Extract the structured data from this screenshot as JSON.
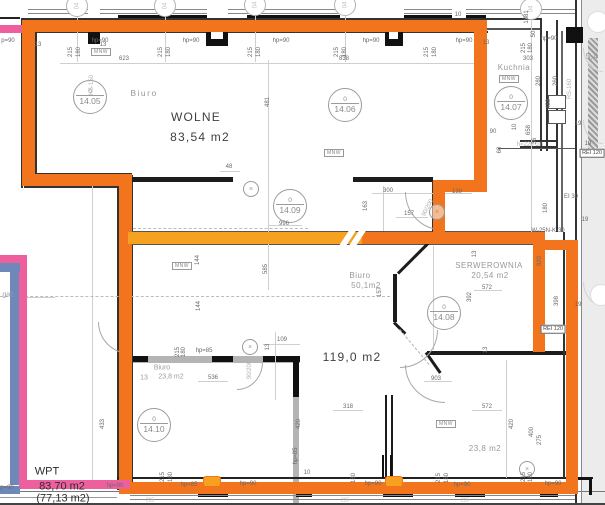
{
  "meta": {
    "kind": "architectural-floor-plan",
    "units_label": "m2"
  },
  "colors": {
    "highlight_orange": "#f2741c",
    "highlight_orange_light": "#f6a11f",
    "highlight_pink": "#ee5f9e",
    "highlight_blue": "#6e88b9",
    "wall_dark": "#1c1c1c",
    "wall_gray": "#b4b4b4",
    "zone_gray": "#ececec"
  },
  "rooms": [
    {
      "name": "wolne",
      "label": "WOLNE",
      "area": "83,54 m2"
    },
    {
      "name": "biuro-4-05",
      "label": "Biuro"
    },
    {
      "name": "biuro-50",
      "label": "Biuro",
      "area": "50,1m2"
    },
    {
      "name": "serwerownia",
      "label": "SERWEROWNIA",
      "area": "20,54 m2"
    },
    {
      "name": "kuchnia",
      "label": "Kuchnia"
    },
    {
      "name": "strefa-119",
      "area": "119,0 m2"
    },
    {
      "name": "biuro-dol",
      "label": "Biuro",
      "area": "23,8 m2",
      "width_note": "13"
    },
    {
      "name": "biuro-praw",
      "area": "23,8 m2"
    },
    {
      "name": "wpt",
      "label": "WPT",
      "area": "83,70 m2",
      "area2": "(77,13 m2)"
    },
    {
      "name": "gaz",
      "label": "gaz."
    }
  ],
  "room_tags": [
    {
      "floor": "0",
      "num": "14.05",
      "x": 90,
      "y": 97
    },
    {
      "floor": "0",
      "num": "14.06",
      "x": 345,
      "y": 105
    },
    {
      "floor": "0",
      "num": "14.07",
      "x": 511,
      "y": 103
    },
    {
      "floor": "0",
      "num": "14.08",
      "x": 444,
      "y": 313
    },
    {
      "floor": "0",
      "num": "14.09",
      "x": 290,
      "y": 206
    },
    {
      "floor": "0",
      "num": "14.10",
      "x": 154,
      "y": 425
    }
  ],
  "grid_bubbles": [
    {
      "label": "04",
      "x": 77,
      "y": 6
    },
    {
      "label": "04",
      "x": 165,
      "y": 6
    },
    {
      "label": "04",
      "x": 255,
      "y": 5
    },
    {
      "label": "04",
      "x": 345,
      "y": 5
    },
    {
      "label": "04",
      "x": 531,
      "y": 9
    },
    {
      "label": "",
      "x": 598,
      "y": 22,
      "faint": true
    },
    {
      "label": "",
      "x": 601,
      "y": 295,
      "faint": true
    }
  ],
  "mnw_label": "MNW",
  "mnw_boxes": [
    {
      "x": 101,
      "y": 52
    },
    {
      "x": 334,
      "y": 153
    },
    {
      "x": 182,
      "y": 266
    },
    {
      "x": 509,
      "y": 79
    },
    {
      "x": 446,
      "y": 424
    }
  ],
  "fire_ratings": [
    {
      "t": "REI 120",
      "x": 592,
      "y": 153
    },
    {
      "t": "REI 120",
      "x": 553,
      "y": 329
    }
  ],
  "labels": [
    {
      "t": "Biuro",
      "x": 144,
      "y": 93,
      "r": 0,
      "c": "gray-lg"
    },
    {
      "t": "WOLNE",
      "x": 196,
      "y": 117,
      "r": 0,
      "c": "big"
    },
    {
      "t": "83,54 m2",
      "x": 200,
      "y": 137,
      "r": 0,
      "c": "big"
    },
    {
      "t": "Biuro",
      "x": 360,
      "y": 276,
      "r": 0,
      "c": "gray-md"
    },
    {
      "t": "50,1m2",
      "x": 366,
      "y": 286,
      "r": 0,
      "c": "gray-md"
    },
    {
      "t": "SERWEROWNIA",
      "x": 489,
      "y": 266,
      "r": 0,
      "c": "gray-md"
    },
    {
      "t": "20,54 m2",
      "x": 490,
      "y": 276,
      "r": 0,
      "c": "gray-md"
    },
    {
      "t": "Kuchnia",
      "x": 514,
      "y": 68,
      "r": 0,
      "c": "gray-md"
    },
    {
      "t": "119,0 m2",
      "x": 352,
      "y": 357,
      "r": 0,
      "c": "big"
    },
    {
      "t": "Biuro",
      "x": 162,
      "y": 368,
      "r": 0,
      "c": "gray-sm"
    },
    {
      "t": "13",
      "x": 144,
      "y": 378,
      "r": 0,
      "c": "gray-sm"
    },
    {
      "t": "23,8 m2",
      "x": 171,
      "y": 377,
      "r": 0,
      "c": "gray-sm"
    },
    {
      "t": "23,8 m2",
      "x": 485,
      "y": 449,
      "r": 0,
      "c": "gray-md"
    },
    {
      "t": "WPT",
      "x": 47,
      "y": 472,
      "r": 0,
      "c": "wpt"
    },
    {
      "t": "83,70 m2",
      "x": 62,
      "y": 487,
      "r": 0,
      "c": "wpt"
    },
    {
      "t": "(77,13 m2)",
      "x": 63,
      "y": 499,
      "r": 0,
      "c": "wpt"
    },
    {
      "t": "gaz.",
      "x": 9,
      "y": 295,
      "r": 0,
      "c": "gray-sm"
    },
    {
      "t": "p=90",
      "x": 8,
      "y": 41,
      "r": 0,
      "c": "dim"
    },
    {
      "t": "13",
      "x": 38,
      "y": 45,
      "r": 0,
      "c": "dim"
    },
    {
      "t": "13",
      "x": 103,
      "y": 45,
      "r": 0,
      "c": "dim"
    },
    {
      "t": "215",
      "x": 71,
      "y": 52,
      "r": -90,
      "c": "dim"
    },
    {
      "t": "180",
      "x": 79,
      "y": 52,
      "r": -90,
      "c": "dim"
    },
    {
      "t": "hp=90",
      "x": 100,
      "y": 41,
      "r": 0,
      "c": "dim"
    },
    {
      "t": "623",
      "x": 124,
      "y": 59,
      "r": 0,
      "c": "dim"
    },
    {
      "t": "215",
      "x": 161,
      "y": 52,
      "r": -90,
      "c": "dim"
    },
    {
      "t": "180",
      "x": 169,
      "y": 52,
      "r": -90,
      "c": "dim"
    },
    {
      "t": "hp=90",
      "x": 191,
      "y": 41,
      "r": 0,
      "c": "dim"
    },
    {
      "t": "215",
      "x": 251,
      "y": 52,
      "r": -90,
      "c": "dim"
    },
    {
      "t": "180",
      "x": 259,
      "y": 52,
      "r": -90,
      "c": "dim"
    },
    {
      "t": "hp=90",
      "x": 281,
      "y": 41,
      "r": 0,
      "c": "dim"
    },
    {
      "t": "215",
      "x": 337,
      "y": 52,
      "r": -90,
      "c": "dim"
    },
    {
      "t": "180",
      "x": 345,
      "y": 52,
      "r": -90,
      "c": "dim"
    },
    {
      "t": "hp=90",
      "x": 371,
      "y": 41,
      "r": 0,
      "c": "dim"
    },
    {
      "t": "838",
      "x": 344,
      "y": 59,
      "r": 0,
      "c": "dim"
    },
    {
      "t": "215",
      "x": 427,
      "y": 52,
      "r": -90,
      "c": "dim"
    },
    {
      "t": "180",
      "x": 435,
      "y": 52,
      "r": -90,
      "c": "dim"
    },
    {
      "t": "hp=90",
      "x": 464,
      "y": 41,
      "r": 0,
      "c": "dim"
    },
    {
      "t": "10",
      "x": 458,
      "y": 15,
      "r": 0,
      "c": "dim"
    },
    {
      "t": "13",
      "x": 486,
      "y": 43,
      "r": 0,
      "c": "dim"
    },
    {
      "t": "1581",
      "x": 527,
      "y": 17,
      "r": -90,
      "c": "dim"
    },
    {
      "t": "50",
      "x": 534,
      "y": 34,
      "r": -90,
      "c": "dim"
    },
    {
      "t": "215",
      "x": 524,
      "y": 48,
      "r": -90,
      "c": "dim"
    },
    {
      "t": "180",
      "x": 531,
      "y": 48,
      "r": -90,
      "c": "dim"
    },
    {
      "t": "hp=90",
      "x": 549,
      "y": 39,
      "r": 0,
      "c": "dim"
    },
    {
      "t": "303",
      "x": 528,
      "y": 59,
      "r": 0,
      "c": "dim"
    },
    {
      "t": "280",
      "x": 539,
      "y": 81,
      "r": -90,
      "c": "dim"
    },
    {
      "t": "260",
      "x": 556,
      "y": 81,
      "r": -90,
      "c": "dim"
    },
    {
      "t": "488",
      "x": 549,
      "y": 104,
      "r": -90,
      "c": "dim"
    },
    {
      "t": "RS-160",
      "x": 570,
      "y": 89,
      "r": -90,
      "c": "dim faint"
    },
    {
      "t": "5,4",
      "x": 592,
      "y": 57,
      "r": 0,
      "c": "gray-md"
    },
    {
      "t": "KS-150",
      "x": 92,
      "y": 85,
      "r": -90,
      "c": "dim faint"
    },
    {
      "t": "10",
      "x": 515,
      "y": 127,
      "r": -90,
      "c": "dim"
    },
    {
      "t": "90",
      "x": 493,
      "y": 132,
      "r": 0,
      "c": "dim"
    },
    {
      "t": "60",
      "x": 500,
      "y": 150,
      "r": -90,
      "c": "dim"
    },
    {
      "t": "h=220 cm",
      "x": 530,
      "y": 145,
      "r": 0,
      "c": "dim faint"
    },
    {
      "t": "658",
      "x": 529,
      "y": 130,
      "r": -90,
      "c": "dim"
    },
    {
      "t": "36",
      "x": 535,
      "y": 141,
      "r": -90,
      "c": "dim"
    },
    {
      "t": "19",
      "x": 578,
      "y": 124,
      "r": 0,
      "c": "dim"
    },
    {
      "t": "19",
      "x": 588,
      "y": 144,
      "r": 0,
      "c": "dim"
    },
    {
      "t": "180",
      "x": 546,
      "y": 208,
      "r": -90,
      "c": "dim"
    },
    {
      "t": "EI 30",
      "x": 571,
      "y": 197,
      "r": 0,
      "c": "dim"
    },
    {
      "t": "19",
      "x": 585,
      "y": 220,
      "r": 0,
      "c": "dim"
    },
    {
      "t": "W-25N-K-30",
      "x": 548,
      "y": 231,
      "r": 0,
      "c": "dim"
    },
    {
      "t": "19",
      "x": 578,
      "y": 305,
      "r": 0,
      "c": "dim"
    },
    {
      "t": "481",
      "x": 268,
      "y": 102,
      "r": -90,
      "c": "dim"
    },
    {
      "t": "48",
      "x": 229,
      "y": 167,
      "r": 0,
      "c": "dim"
    },
    {
      "t": "996",
      "x": 284,
      "y": 224,
      "r": 0,
      "c": "dim"
    },
    {
      "t": "300",
      "x": 388,
      "y": 191,
      "r": 0,
      "c": "dim"
    },
    {
      "t": "139",
      "x": 457,
      "y": 192,
      "r": 0,
      "c": "dim"
    },
    {
      "t": "157",
      "x": 409,
      "y": 214,
      "r": 0,
      "c": "dim"
    },
    {
      "t": "163",
      "x": 366,
      "y": 206,
      "r": -90,
      "c": "dim"
    },
    {
      "t": "90/200",
      "x": 428,
      "y": 208,
      "r": -62,
      "c": "dim faint"
    },
    {
      "t": "144",
      "x": 198,
      "y": 260,
      "r": -90,
      "c": "dim"
    },
    {
      "t": "144",
      "x": 199,
      "y": 306,
      "r": -90,
      "c": "dim"
    },
    {
      "t": "585",
      "x": 266,
      "y": 269,
      "r": -90,
      "c": "dim"
    },
    {
      "t": "820",
      "x": 540,
      "y": 261,
      "r": -90,
      "c": "dim"
    },
    {
      "t": "392",
      "x": 470,
      "y": 297,
      "r": -90,
      "c": "dim"
    },
    {
      "t": "398",
      "x": 557,
      "y": 301,
      "r": -90,
      "c": "dim"
    },
    {
      "t": "157",
      "x": 380,
      "y": 292,
      "r": -90,
      "c": "dim"
    },
    {
      "t": "572",
      "x": 487,
      "y": 288,
      "r": 0,
      "c": "dim"
    },
    {
      "t": "13",
      "x": 475,
      "y": 254,
      "r": -90,
      "c": "dim"
    },
    {
      "t": "13",
      "x": 486,
      "y": 350,
      "r": -90,
      "c": "dim"
    },
    {
      "t": "90/200",
      "x": 250,
      "y": 370,
      "r": -90,
      "c": "dim faint"
    },
    {
      "t": "903",
      "x": 436,
      "y": 379,
      "r": 0,
      "c": "dim"
    },
    {
      "t": "109",
      "x": 282,
      "y": 340,
      "r": 0,
      "c": "dim"
    },
    {
      "t": "13",
      "x": 268,
      "y": 347,
      "r": -90,
      "c": "dim"
    },
    {
      "t": "215",
      "x": 178,
      "y": 352,
      "r": -90,
      "c": "dim"
    },
    {
      "t": "180",
      "x": 184,
      "y": 352,
      "r": -90,
      "c": "dim"
    },
    {
      "t": "hp=85",
      "x": 204,
      "y": 351,
      "r": 0,
      "c": "dim"
    },
    {
      "t": "536",
      "x": 213,
      "y": 378,
      "r": 0,
      "c": "dim"
    },
    {
      "t": "318",
      "x": 348,
      "y": 407,
      "r": 0,
      "c": "dim"
    },
    {
      "t": "572",
      "x": 487,
      "y": 407,
      "r": 0,
      "c": "dim"
    },
    {
      "t": "433",
      "x": 103,
      "y": 424,
      "r": -90,
      "c": "dim"
    },
    {
      "t": "420",
      "x": 299,
      "y": 424,
      "r": -90,
      "c": "dim"
    },
    {
      "t": "420",
      "x": 512,
      "y": 424,
      "r": -90,
      "c": "dim"
    },
    {
      "t": "400",
      "x": 532,
      "y": 432,
      "r": -90,
      "c": "dim"
    },
    {
      "t": "275",
      "x": 540,
      "y": 440,
      "r": -90,
      "c": "dim"
    },
    {
      "t": "p=90",
      "x": 7,
      "y": 488,
      "r": 0,
      "c": "dim"
    },
    {
      "t": "hp=90",
      "x": 115,
      "y": 486,
      "r": 0,
      "c": "dim"
    },
    {
      "t": "215",
      "x": 163,
      "y": 477,
      "r": -90,
      "c": "dim"
    },
    {
      "t": "180",
      "x": 171,
      "y": 477,
      "r": -90,
      "c": "dim"
    },
    {
      "t": "hp=85",
      "x": 189,
      "y": 485,
      "r": 0,
      "c": "dim"
    },
    {
      "t": "hp=90",
      "x": 248,
      "y": 484,
      "r": 0,
      "c": "dim"
    },
    {
      "t": "hp=85",
      "x": 296,
      "y": 456,
      "r": -90,
      "c": "dim"
    },
    {
      "t": "10",
      "x": 307,
      "y": 473,
      "r": 0,
      "c": "dim"
    },
    {
      "t": "180",
      "x": 354,
      "y": 478,
      "r": -90,
      "c": "dim"
    },
    {
      "t": "hp=90",
      "x": 373,
      "y": 484,
      "r": 0,
      "c": "dim"
    },
    {
      "t": "215",
      "x": 439,
      "y": 478,
      "r": -90,
      "c": "dim"
    },
    {
      "t": "180",
      "x": 447,
      "y": 478,
      "r": -90,
      "c": "dim"
    },
    {
      "t": "hp=90",
      "x": 462,
      "y": 485,
      "r": 0,
      "c": "dim"
    },
    {
      "t": "215",
      "x": 524,
      "y": 477,
      "r": -90,
      "c": "dim"
    },
    {
      "t": "180",
      "x": 531,
      "y": 477,
      "r": -90,
      "c": "dim"
    },
    {
      "t": "hp=90",
      "x": 553,
      "y": 484,
      "r": 0,
      "c": "dim"
    },
    {
      "t": "215",
      "x": 150,
      "y": 501,
      "r": 0,
      "c": "tinyf"
    },
    {
      "t": "215",
      "x": 345,
      "y": 501,
      "r": 0,
      "c": "tinyf"
    },
    {
      "t": "215",
      "x": 465,
      "y": 501,
      "r": 0,
      "c": "tinyf"
    }
  ]
}
